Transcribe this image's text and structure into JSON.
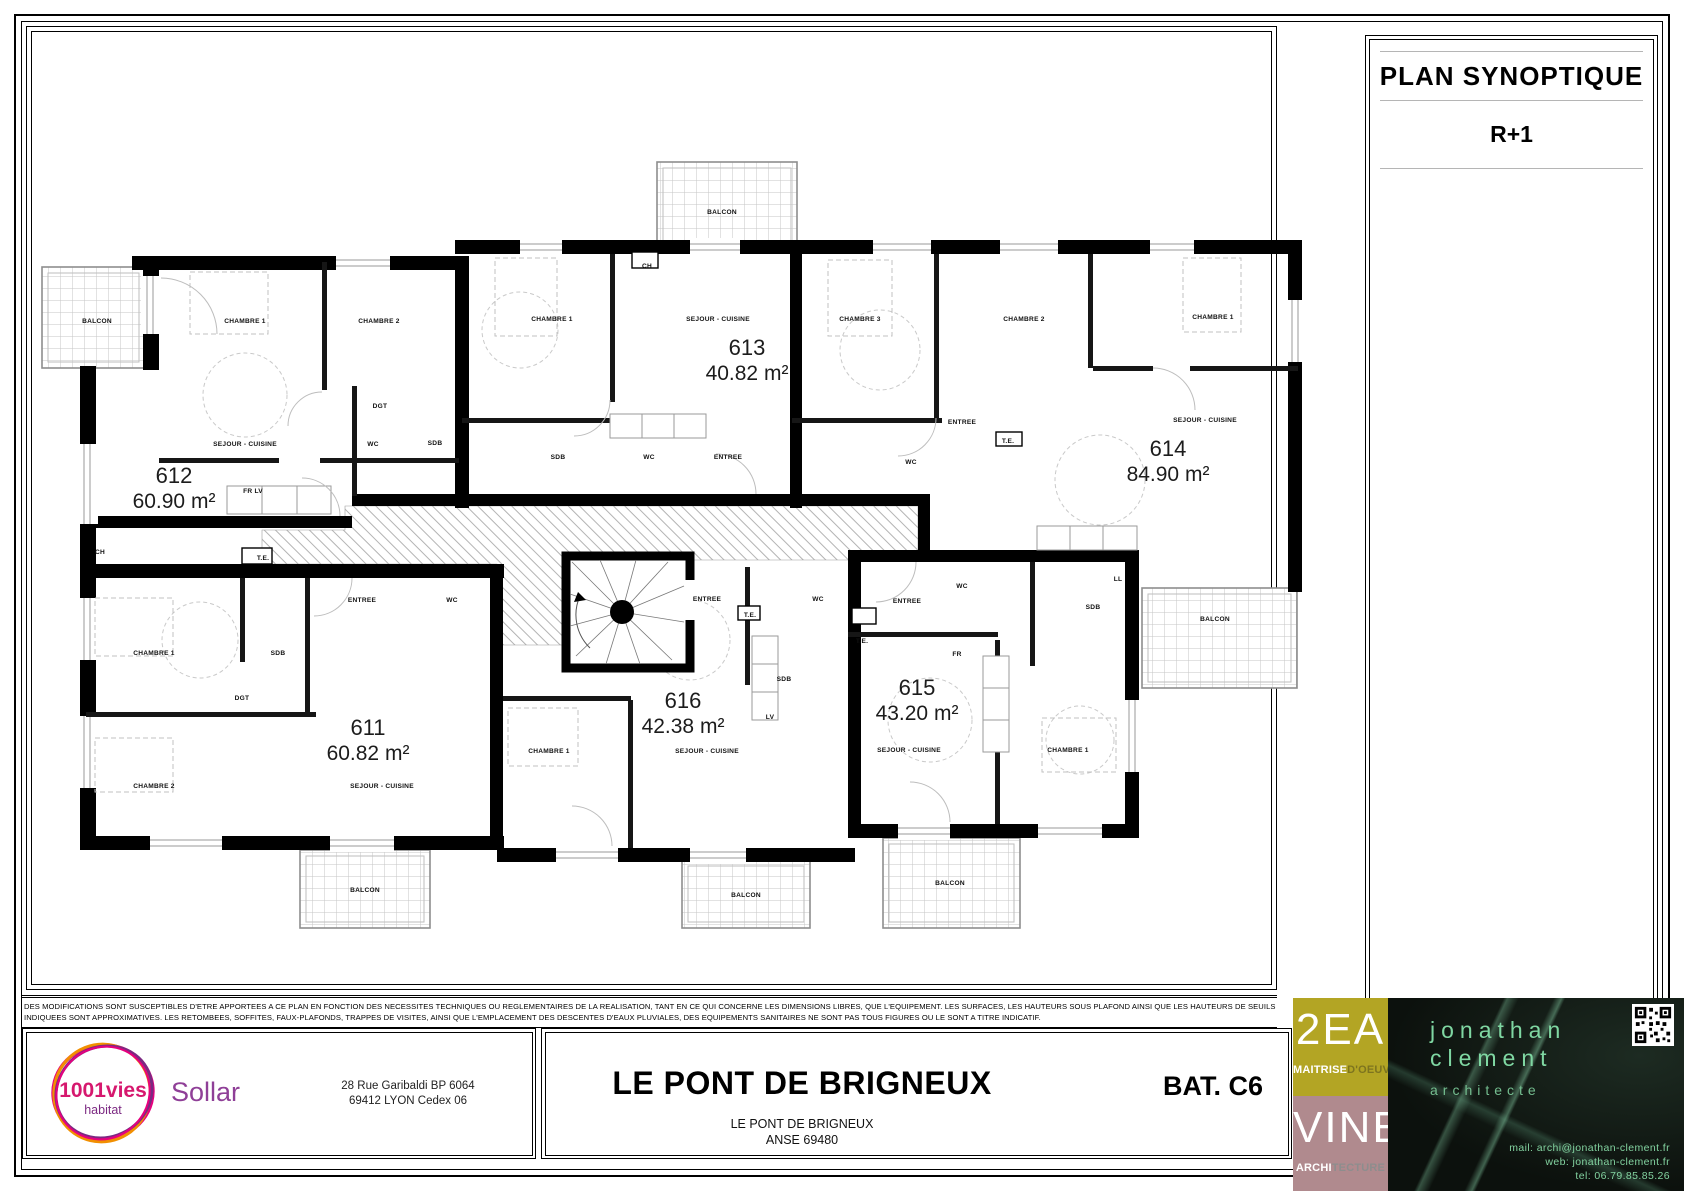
{
  "panel": {
    "title": "PLAN SYNOPTIQUE",
    "level": "R+1"
  },
  "plan": {
    "apartments": [
      {
        "number": "612",
        "area": "60.90 m²",
        "x": 174,
        "y": 483,
        "rooms": [
          {
            "label": "BALCON",
            "x": 97,
            "y": 323
          },
          {
            "label": "CHAMBRE 1",
            "x": 245,
            "y": 323
          },
          {
            "label": "CHAMBRE 2",
            "x": 379,
            "y": 323
          },
          {
            "label": "DGT",
            "x": 380,
            "y": 408
          },
          {
            "label": "WC",
            "x": 373,
            "y": 446
          },
          {
            "label": "SDB",
            "x": 435,
            "y": 445
          },
          {
            "label": "SEJOUR - CUISINE",
            "x": 245,
            "y": 446
          },
          {
            "label": "FR LV",
            "x": 253,
            "y": 493
          }
        ]
      },
      {
        "number": "613",
        "area": "40.82 m²",
        "x": 747,
        "y": 355,
        "rooms": [
          {
            "label": "BALCON",
            "x": 722,
            "y": 214
          },
          {
            "label": "CH",
            "x": 647,
            "y": 268
          },
          {
            "label": "CHAMBRE 1",
            "x": 552,
            "y": 321
          },
          {
            "label": "SEJOUR - CUISINE",
            "x": 718,
            "y": 321
          },
          {
            "label": "SDB",
            "x": 558,
            "y": 459
          },
          {
            "label": "WC",
            "x": 649,
            "y": 459
          },
          {
            "label": "ENTREE",
            "x": 728,
            "y": 459
          }
        ]
      },
      {
        "number": "614",
        "area": "84.90 m²",
        "x": 1168,
        "y": 456,
        "rooms": [
          {
            "label": "CHAMBRE 3",
            "x": 860,
            "y": 321
          },
          {
            "label": "CHAMBRE 2",
            "x": 1024,
            "y": 321
          },
          {
            "label": "CHAMBRE 1",
            "x": 1213,
            "y": 319
          },
          {
            "label": "ENTREE",
            "x": 962,
            "y": 424
          },
          {
            "label": "T.E.",
            "x": 1008,
            "y": 443
          },
          {
            "label": "WC",
            "x": 911,
            "y": 464
          },
          {
            "label": "SEJOUR - CUISINE",
            "x": 1205,
            "y": 422
          },
          {
            "label": "BALCON",
            "x": 1215,
            "y": 621
          }
        ]
      },
      {
        "number": "611",
        "area": "60.82 m²",
        "x": 368,
        "y": 735,
        "rooms": [
          {
            "label": "CH",
            "x": 100,
            "y": 554
          },
          {
            "label": "T.E.",
            "x": 263,
            "y": 560
          },
          {
            "label": "ENTREE",
            "x": 362,
            "y": 602
          },
          {
            "label": "WC",
            "x": 452,
            "y": 602
          },
          {
            "label": "CHAMBRE 1",
            "x": 154,
            "y": 655
          },
          {
            "label": "SDB",
            "x": 278,
            "y": 655
          },
          {
            "label": "DGT",
            "x": 242,
            "y": 700
          },
          {
            "label": "CHAMBRE 2",
            "x": 154,
            "y": 788
          },
          {
            "label": "SEJOUR - CUISINE",
            "x": 382,
            "y": 788
          },
          {
            "label": "BALCON",
            "x": 365,
            "y": 892
          }
        ]
      },
      {
        "number": "616",
        "area": "42.38 m²",
        "x": 683,
        "y": 708,
        "rooms": [
          {
            "label": "ENTREE",
            "x": 707,
            "y": 601
          },
          {
            "label": "WC",
            "x": 818,
            "y": 601
          },
          {
            "label": "T.E.",
            "x": 750,
            "y": 617
          },
          {
            "label": "SDB",
            "x": 784,
            "y": 681
          },
          {
            "label": "LV",
            "x": 770,
            "y": 719
          },
          {
            "label": "CHAMBRE 1",
            "x": 549,
            "y": 753
          },
          {
            "label": "SEJOUR - CUISINE",
            "x": 707,
            "y": 753
          },
          {
            "label": "BALCON",
            "x": 746,
            "y": 897
          }
        ]
      },
      {
        "number": "615",
        "area": "43.20 m²",
        "x": 917,
        "y": 695,
        "rooms": [
          {
            "label": "WC",
            "x": 962,
            "y": 588
          },
          {
            "label": "ENTREE",
            "x": 907,
            "y": 603
          },
          {
            "label": "T.E.",
            "x": 862,
            "y": 643
          },
          {
            "label": "LL",
            "x": 1118,
            "y": 581
          },
          {
            "label": "SDB",
            "x": 1093,
            "y": 609
          },
          {
            "label": "FR",
            "x": 957,
            "y": 656
          },
          {
            "label": "SEJOUR - CUISINE",
            "x": 909,
            "y": 752
          },
          {
            "label": "CHAMBRE 1",
            "x": 1068,
            "y": 752
          },
          {
            "label": "BALCON",
            "x": 950,
            "y": 885
          }
        ]
      }
    ]
  },
  "disclaimer": {
    "line1": "DES MODIFICATIONS SONT SUSCEPTIBLES D'ETRE APPORTEES A CE PLAN EN FONCTION DES NECESSITES TECHNIQUES OU REGLEMENTAIRES DE LA REALISATION, TANT EN CE QUI CONCERNE LES DIMENSIONS LIBRES, QUE L'EQUIPEMENT. LES SURFACES, LES HAUTEURS SOUS PLAFOND AINSI QUE LES HAUTEURS DE SEUILS C",
    "line2": "INDIQUEES SONT APPROXIMATIVES. LES RETOMBEES, SOFFITES, FAUX-PLAFONDS, TRAPPES DE VISITES, AINSI QUE L'EMPLACEMENT DES DESCENTES D'EAUX PLUVIALES, DES EQUIPEMENTS SANITAIRES NE SONT PAS TOUS FIGURES OU LE SONT A TITRE INDICATIF."
  },
  "footer": {
    "client": {
      "logo_line1": "1001vies",
      "logo_line2": "habitat",
      "brand": "Sollar",
      "address_line1": "28 Rue Garibaldi BP 6064",
      "address_line2": "69412 LYON Cedex 06",
      "logo_colors": {
        "pink": "#e6007e",
        "orange": "#f18f01",
        "purple": "#7c2982",
        "brand_purple": "#8f3f97"
      }
    },
    "project": {
      "title": "LE PONT DE BRIGNEUX",
      "subtitle_line1": "LE PONT DE BRIGNEUX",
      "subtitle_line2": "ANSE 69480",
      "building": "BAT. C6"
    },
    "moe": {
      "top_big": "2EA",
      "top_sub_strong": "MAITRISE",
      "top_sub_muted": "D'OEUVRE",
      "bottom_big": "VINE",
      "bottom_sub_strong": "ARCHI",
      "bottom_sub_muted": "TECTURE",
      "color_top": "#b3a524",
      "color_bottom": "#b08a8e"
    },
    "architect": {
      "name_line1": "jonathan",
      "name_line2": "clement",
      "role": "architecte",
      "mail": "mail: archi@jonathan-clement.fr",
      "web": "web: jonathan-clement.fr",
      "tel": "tel: 06.79.85.85.26",
      "text_color": "#7fd7a2"
    }
  }
}
